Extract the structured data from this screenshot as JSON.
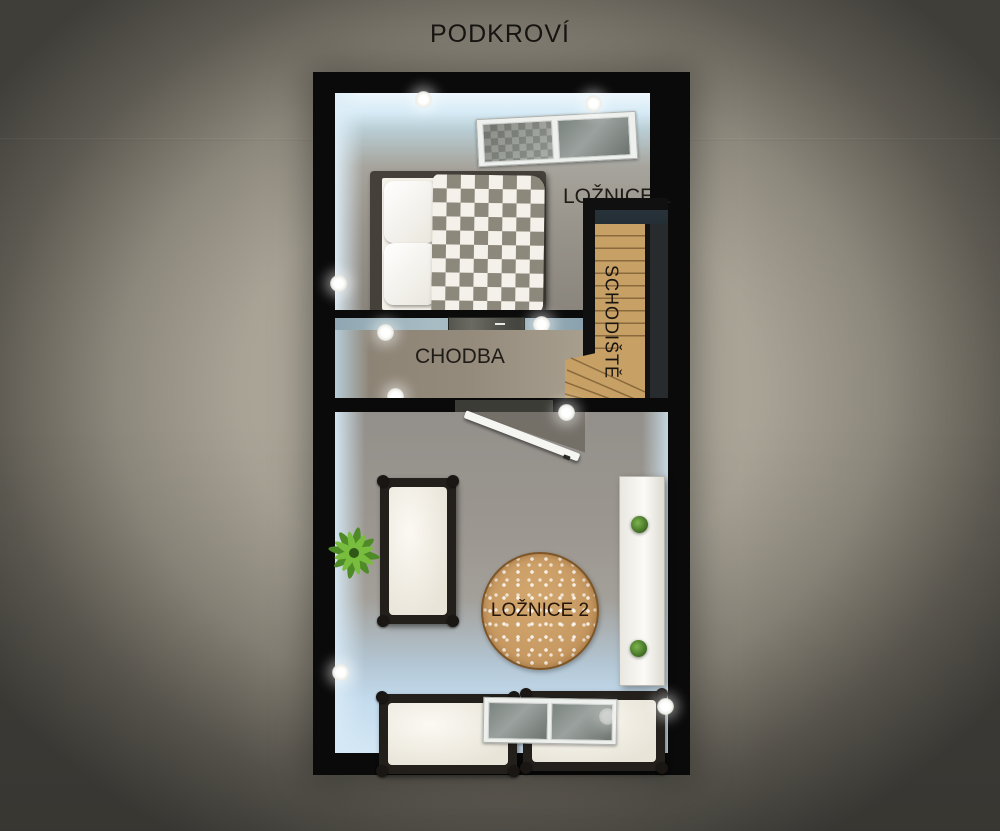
{
  "page": {
    "title": "PODKROVÍ"
  },
  "rooms": {
    "loznice1": {
      "label": "LOŽNICE 1"
    },
    "chodba": {
      "label": "CHODBA"
    },
    "schodiste": {
      "label": "SCHODIŠTĚ"
    },
    "loznice2": {
      "label": "LOŽNICE 2"
    }
  },
  "objects": {
    "double_bed": "double-bed",
    "single_beds": [
      "single-bed-left",
      "single-bed-bottom-1",
      "single-bed-bottom-2"
    ],
    "windows": [
      "skylight-window-top",
      "skylight-window-bottom"
    ],
    "rug": "round-rug",
    "cabinet": "white-cabinet",
    "plants": [
      "potted-plant-small-top",
      "palm-plant",
      "potted-plant-small-bottom"
    ],
    "stairs": "wooden-staircase",
    "door": [
      "hall-sliding-door",
      "bedroom2-open-door"
    ],
    "wall_lights": "wall-light"
  },
  "colors": {
    "wall": "#0a0a0a",
    "bg-center": "#b4ae9f",
    "bg-edge": "#403e39",
    "stairs": "#c7a065",
    "rug": "#c89a63",
    "rug-border": "#7d5527",
    "mattress": "#f3f0e8",
    "blanket": "#8d887c",
    "door": "#f5f5f2"
  }
}
